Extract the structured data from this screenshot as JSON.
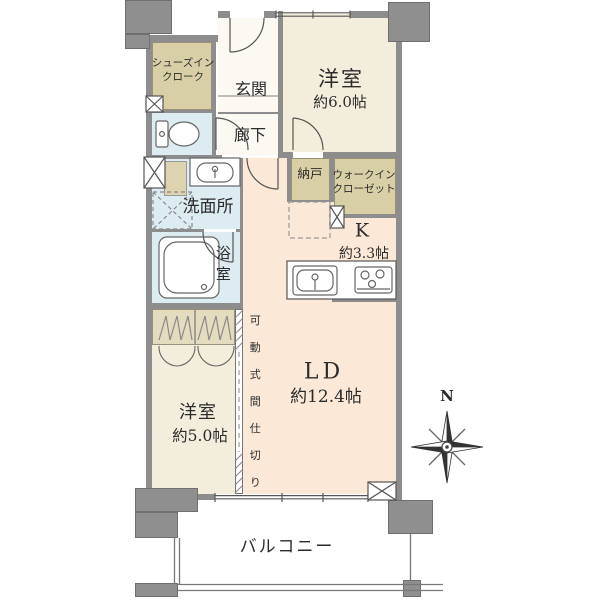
{
  "rooms": {
    "sic": {
      "line1": "シューズイン",
      "line2": "クローク"
    },
    "genkan": {
      "label": "玄関"
    },
    "bedroom6": {
      "name": "洋室",
      "size": "約6.0帖"
    },
    "hallway": {
      "label": "廊下"
    },
    "washroom": {
      "label": "洗面所"
    },
    "bathroom": {
      "label": "浴室"
    },
    "storage": {
      "label": "納戸"
    },
    "wic": {
      "line1": "ウォークイン",
      "line2": "クローゼット"
    },
    "kitchen": {
      "name": "K",
      "size": "約3.3帖"
    },
    "living": {
      "name": "LD",
      "size": "約12.4帖"
    },
    "bedroom5": {
      "name": "洋室",
      "size": "約5.0帖"
    },
    "partition": {
      "label": "可動式間仕切り"
    },
    "balcony": {
      "label": "バルコニー"
    }
  },
  "compass": {
    "north": "N"
  },
  "colors": {
    "wall": "#8d8d8d",
    "closet_tan": "#d8cfa6",
    "wet_area_blue": "#dcecf0",
    "bedroom_cream": "#f3eedb",
    "living_peach": "#fbe8d6",
    "background": "#ffffff"
  }
}
